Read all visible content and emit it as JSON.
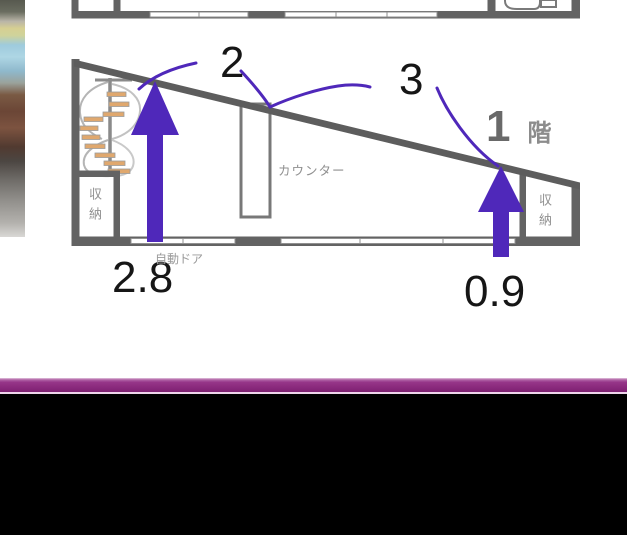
{
  "annotations": {
    "label_2": "2",
    "label_3": "3",
    "height_left": "2.8",
    "height_right": "0.9",
    "arrow_color": "#4f28ba"
  },
  "plan": {
    "floor_number": "1",
    "floor_suffix": "階",
    "counter": "カウンター",
    "storage_left": "収納",
    "storage_right": "収納",
    "auto_door": "自動ドア",
    "wall_color": "#636363"
  },
  "footer": {
    "bar_color": "#8e2d80",
    "background": "#000000"
  }
}
